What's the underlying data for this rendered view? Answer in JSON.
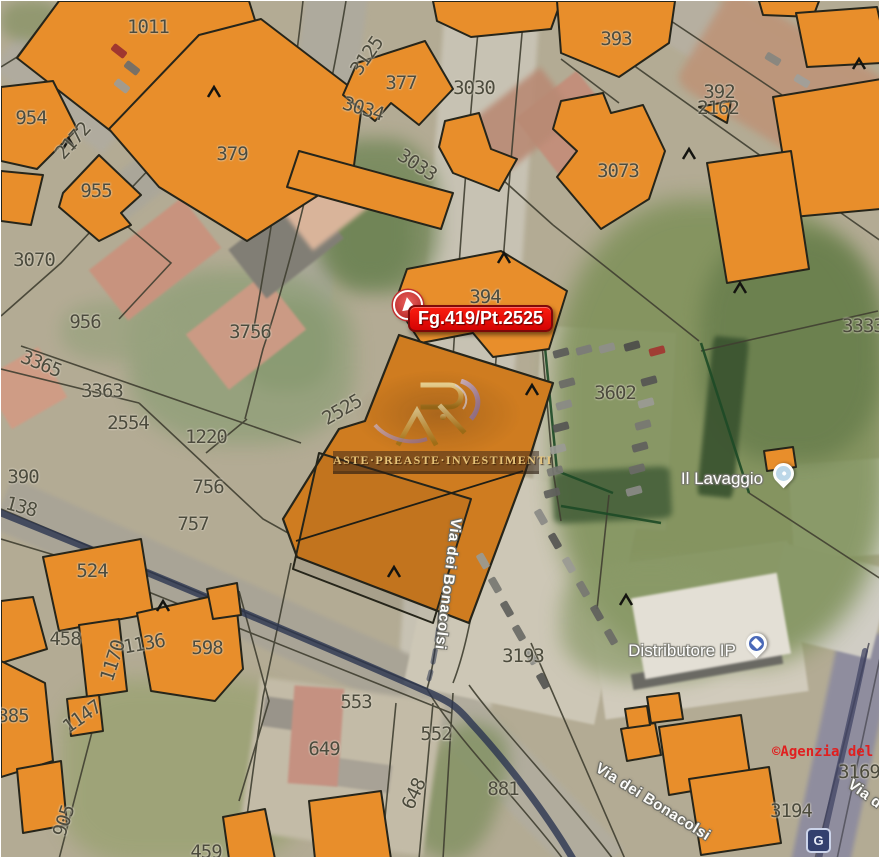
{
  "map": {
    "callout": {
      "label": "Fg.419/Pt.2525"
    },
    "watermark": {
      "brand": "ASTE·PREASTE·INVESTIMENTI"
    },
    "copyright": {
      "label": "©Agenzia del"
    },
    "road_badge": {
      "label": "G"
    },
    "poi": {
      "lavaggio": {
        "label": "Il Lavaggio"
      },
      "distributore": {
        "label": "Distributore IP"
      }
    },
    "street_labels": [
      {
        "t": "Via dei Bonacolsi",
        "x": 447,
        "y": 583,
        "r": 97
      },
      {
        "t": "Via dei Bonacolsi",
        "x": 652,
        "y": 801,
        "r": 32
      },
      {
        "t": "Via d",
        "x": 864,
        "y": 793,
        "r": 36
      }
    ],
    "parcel_labels": [
      {
        "t": "1011",
        "x": 147,
        "y": 26,
        "r": 0
      },
      {
        "t": "954",
        "x": 30,
        "y": 117,
        "r": 0
      },
      {
        "t": "2172",
        "x": 72,
        "y": 140,
        "r": -48
      },
      {
        "t": "955",
        "x": 95,
        "y": 190,
        "r": 0
      },
      {
        "t": "379",
        "x": 231,
        "y": 153,
        "r": 0
      },
      {
        "t": "3070",
        "x": 33,
        "y": 259,
        "r": 0
      },
      {
        "t": "956",
        "x": 84,
        "y": 321,
        "r": 0
      },
      {
        "t": "3756",
        "x": 249,
        "y": 331,
        "r": 0
      },
      {
        "t": "3365",
        "x": 40,
        "y": 363,
        "r": 22
      },
      {
        "t": "3363",
        "x": 101,
        "y": 390,
        "r": 0
      },
      {
        "t": "1220",
        "x": 205,
        "y": 436,
        "r": 0
      },
      {
        "t": "2554",
        "x": 127,
        "y": 422,
        "r": 0
      },
      {
        "t": "756",
        "x": 207,
        "y": 486,
        "r": 0
      },
      {
        "t": "757",
        "x": 192,
        "y": 523,
        "r": 0
      },
      {
        "t": "390",
        "x": 22,
        "y": 476,
        "r": 0
      },
      {
        "t": "138",
        "x": 20,
        "y": 506,
        "r": 15
      },
      {
        "t": "524",
        "x": 91,
        "y": 570,
        "r": 0
      },
      {
        "t": "458",
        "x": 64,
        "y": 638,
        "r": 0
      },
      {
        "t": "1170",
        "x": 112,
        "y": 660,
        "r": -72
      },
      {
        "t": "1136",
        "x": 143,
        "y": 643,
        "r": -10
      },
      {
        "t": "598",
        "x": 206,
        "y": 647,
        "r": 0
      },
      {
        "t": "385",
        "x": 12,
        "y": 715,
        "r": 0
      },
      {
        "t": "1147",
        "x": 81,
        "y": 716,
        "r": -35
      },
      {
        "t": "905",
        "x": 63,
        "y": 820,
        "r": -72
      },
      {
        "t": "459",
        "x": 205,
        "y": 851,
        "r": 0
      },
      {
        "t": "553",
        "x": 355,
        "y": 701,
        "r": 0
      },
      {
        "t": "552",
        "x": 435,
        "y": 733,
        "r": 0
      },
      {
        "t": "649",
        "x": 323,
        "y": 748,
        "r": 0
      },
      {
        "t": "648",
        "x": 413,
        "y": 793,
        "r": -65
      },
      {
        "t": "881",
        "x": 502,
        "y": 788,
        "r": 0
      },
      {
        "t": "3193",
        "x": 522,
        "y": 655,
        "r": 0
      },
      {
        "t": "3602",
        "x": 614,
        "y": 392,
        "r": 0
      },
      {
        "t": "394",
        "x": 484,
        "y": 296,
        "r": 0
      },
      {
        "t": "2525",
        "x": 341,
        "y": 409,
        "r": -30
      },
      {
        "t": "377",
        "x": 400,
        "y": 82,
        "r": 0
      },
      {
        "t": "3030",
        "x": 473,
        "y": 87,
        "r": 0
      },
      {
        "t": "3034",
        "x": 362,
        "y": 108,
        "r": 17
      },
      {
        "t": "3033",
        "x": 416,
        "y": 164,
        "r": 33
      },
      {
        "t": "3125",
        "x": 366,
        "y": 55,
        "r": -55
      },
      {
        "t": "393",
        "x": 615,
        "y": 38,
        "r": 0
      },
      {
        "t": "392",
        "x": 718,
        "y": 91,
        "r": 0
      },
      {
        "t": "2162",
        "x": 717,
        "y": 107,
        "r": 0
      },
      {
        "t": "3073",
        "x": 617,
        "y": 170,
        "r": 0
      },
      {
        "t": "3333",
        "x": 862,
        "y": 325,
        "r": 0
      },
      {
        "t": "3169",
        "x": 858,
        "y": 771,
        "r": 0
      },
      {
        "t": "3194",
        "x": 790,
        "y": 810,
        "r": 0
      }
    ]
  },
  "colors": {
    "building_orange": "#e88e2b",
    "parcel_orange": "#cf7c20",
    "outline": "#26251a",
    "callout_red": "#ee0606",
    "callout_border": "#7e0909",
    "watermark_gold": "#d8a94e",
    "watermark_swoosh": "#9b7fc0",
    "route_navy": "#2b3550",
    "parcel_label_gray": "#4c4b3d",
    "copyright_red": "#e02020"
  }
}
